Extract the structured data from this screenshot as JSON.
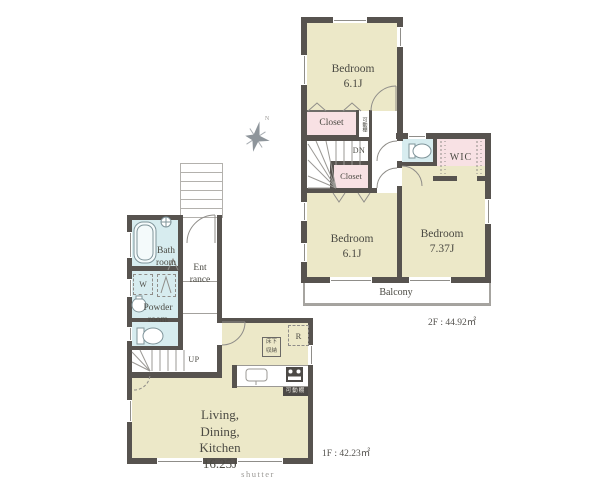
{
  "f2": {
    "bedroom1_name": "Bedroom",
    "bedroom1_size": "6.1J",
    "bedroom2_name": "Bedroom",
    "bedroom2_size": "6.1J",
    "bedroom3_name": "Bedroom",
    "bedroom3_size": "7.37J",
    "closet1": "Closet",
    "closet2": "Closet",
    "wic": "WIC",
    "balcony": "Balcony",
    "dn": "DN",
    "shelf": "可動棚",
    "area": "2F : 44.92㎡"
  },
  "f1": {
    "bath1": "Bath",
    "bath2": "room",
    "powder1": "Powder",
    "powder2": "room",
    "ent1": "Ent",
    "ent2": "rance",
    "ldk1": "Living,",
    "ldk2": "Dining,",
    "ldk3": "Kitchen",
    "ldk4": "16.25J",
    "w": "W",
    "up": "UP",
    "r": "R",
    "ufs1": "床下",
    "ufs2": "収納",
    "shelf": "可動棚",
    "shutter": "shutter",
    "area": "1F : 42.23㎡"
  },
  "compass": {
    "n": "N"
  },
  "colors": {
    "wall": "#57534f",
    "room_yellow": "#ece8c8",
    "room_pink": "#f8e1e4",
    "room_blue": "#d7ecef",
    "line": "#8f8d89",
    "text": "#4b4a43",
    "muted": "#9a9894"
  }
}
